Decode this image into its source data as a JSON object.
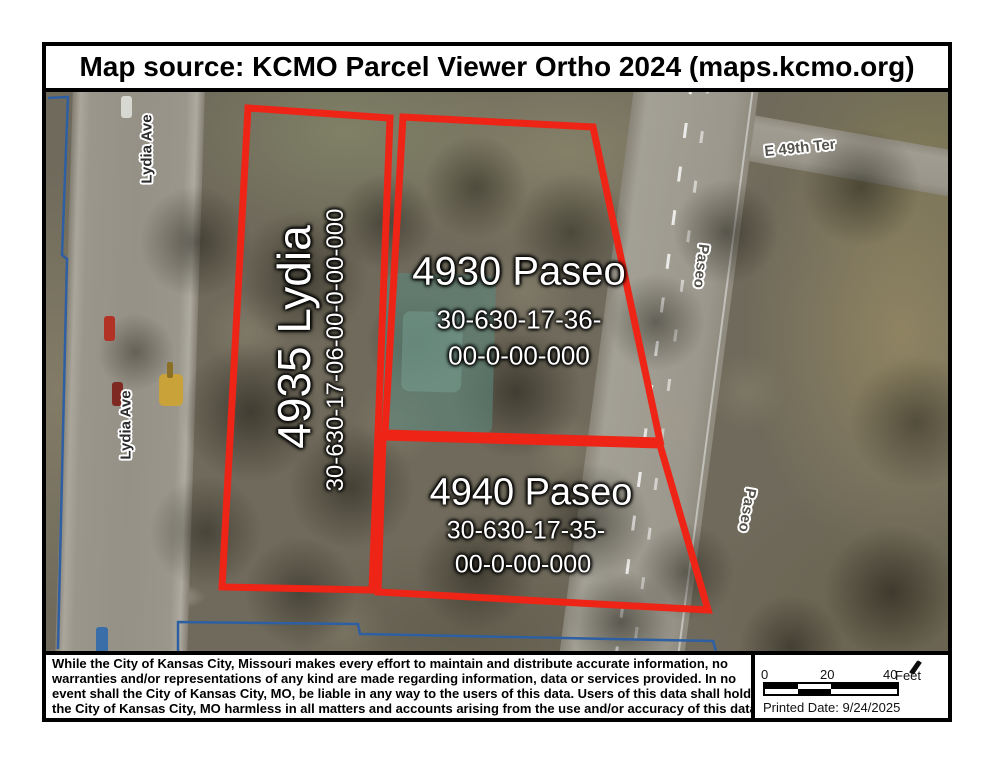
{
  "title": "Map source: KCMO Parcel Viewer Ortho 2024 (maps.kcmo.org)",
  "streets": {
    "lydia": "Lydia Ave",
    "e49th": "E 49th Ter",
    "paseo": "Paseo"
  },
  "parcels": {
    "lydia4935": {
      "address": "4935 Lydia",
      "parcel_id": "30-630-17-06-00-0-00-000"
    },
    "paseo4930": {
      "address": "4930 Paseo",
      "id_line1": "30-630-17-36-",
      "id_line2": "00-0-00-000"
    },
    "paseo4940": {
      "address": "4940 Paseo",
      "id_line1": "30-630-17-35-",
      "id_line2": "00-0-00-000"
    }
  },
  "disclaimer_lines": [
    "While the City of Kansas City, Missouri makes every effort to maintain and distribute accurate information, no",
    "warranties and/or representations of any kind are made regarding information, data or services provided. In no",
    "event shall the City of Kansas City, MO, be liable in any way to the users of this data. Users of this data shall hold",
    "the City of Kansas City, MO harmless in all matters and accounts arising from the use and/or accuracy of this data."
  ],
  "scale_bar": {
    "ticks": [
      "0",
      "20",
      "40"
    ],
    "unit": "Feet",
    "printed_date": "Printed Date: 9/24/2025"
  },
  "colors": {
    "parcel_outline_red": "#ee2417",
    "boundary_blue": "#2e5fa3"
  }
}
